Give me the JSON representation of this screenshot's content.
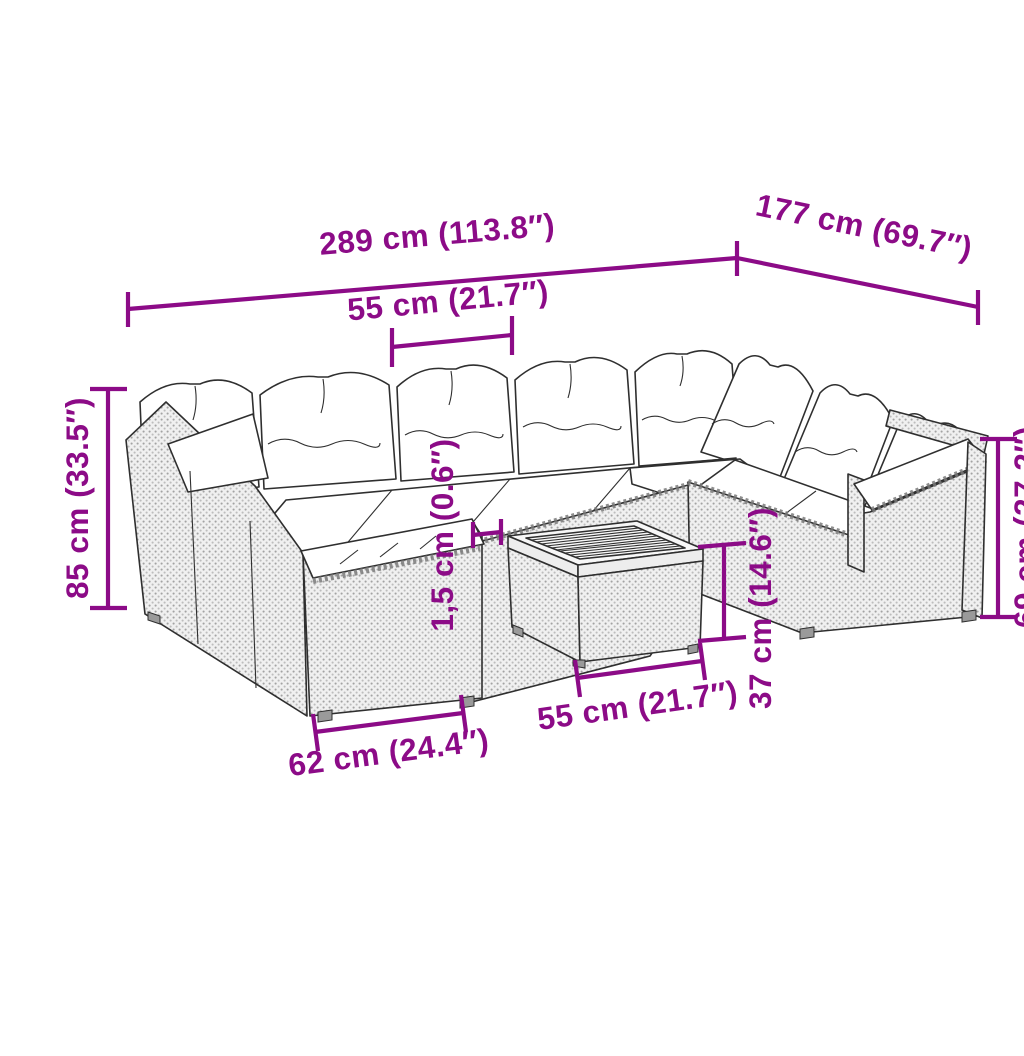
{
  "image": {
    "type": "furniture-dimension-diagram",
    "subject": "rattan garden lounge sofa set with cushions and square slatted coffee table",
    "background": "#ffffff"
  },
  "colors": {
    "annotation": "#8C0B87",
    "outline": "#2f2f2f",
    "rattan_light": "#f0f0f0",
    "rattan_dot": "#a3a3a3",
    "cushion": "#ffffff"
  },
  "dimensions": [
    {
      "id": "overall-width",
      "label": "289 cm (113.8″)"
    },
    {
      "id": "overall-depth",
      "label": "177 cm (69.7″)"
    },
    {
      "id": "seat-width",
      "label": "55 cm (21.7″)"
    },
    {
      "id": "overall-height",
      "label": "85 cm (33.5″)"
    },
    {
      "id": "cushion-thickness",
      "label": "1,5 cm (0.6″)"
    },
    {
      "id": "armrest-height",
      "label": "69 cm (27.2″)"
    },
    {
      "id": "table-height",
      "label": "37 cm (14.6″)"
    },
    {
      "id": "table-top-width",
      "label": "55 cm (21.7″)"
    },
    {
      "id": "section-width",
      "label": "62 cm (24.4″)"
    }
  ]
}
